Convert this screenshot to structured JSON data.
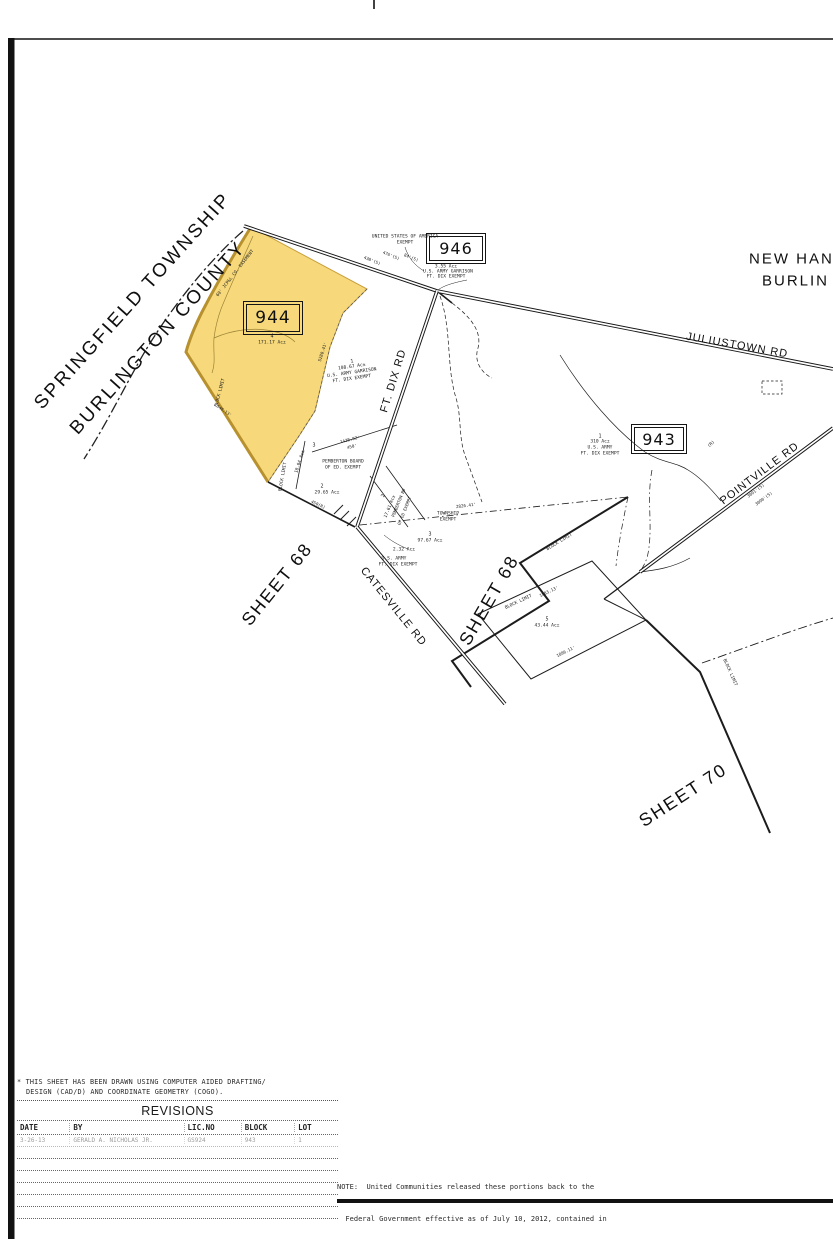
{
  "map": {
    "parcel_fill": "#f7d97b",
    "parcel_edge": "#b8912f",
    "blocks": [
      {
        "label": "944"
      },
      {
        "label": "946"
      },
      {
        "label": "943"
      }
    ],
    "annotations": [
      {
        "n": "township-name",
        "t": "SPRINGFIELD TOWNSHIP",
        "x": 133,
        "y": 301,
        "r": -48,
        "s": 19,
        "ls": 2.5,
        "f": "s"
      },
      {
        "n": "county-name",
        "t": "BURLINGTON COUNTY",
        "x": 158,
        "y": 338,
        "r": -48,
        "s": 19,
        "ls": 2.5,
        "f": "s"
      },
      {
        "n": "adjacent-township-name",
        "t": "NEW HAN",
        "x": 749,
        "y": 259,
        "r": 0,
        "s": 15,
        "ls": 2,
        "f": "s",
        "a": "l"
      },
      {
        "n": "adjacent-county-name",
        "t": "BURLIN",
        "x": 762,
        "y": 281,
        "r": 0,
        "s": 15,
        "ls": 2,
        "f": "s",
        "a": "l"
      },
      {
        "n": "owner-usa-line1",
        "t": "UNITED STATES OF AMERICA",
        "x": 405,
        "y": 238,
        "r": 0,
        "s": 4.6
      },
      {
        "n": "owner-usa-line2",
        "t": "EXEMPT",
        "x": 405,
        "y": 243.5,
        "r": 0,
        "s": 4.6
      },
      {
        "n": "dim-438",
        "t": "438'(S)",
        "x": 372,
        "y": 261,
        "r": 22,
        "s": 4.2
      },
      {
        "n": "dim-476",
        "t": "476'(S)",
        "x": 391,
        "y": 256,
        "r": 22,
        "s": 4.2
      },
      {
        "n": "dim-84",
        "t": "84'(S)",
        "x": 411,
        "y": 258,
        "r": 22,
        "s": 4.2
      },
      {
        "n": "parcel-355-acres",
        "t": "3.55 Ac±",
        "x": 446,
        "y": 268,
        "r": 0,
        "s": 4.6
      },
      {
        "n": "parcel-355-owner-1",
        "t": "U.S. ARMY GARRISON",
        "x": 448,
        "y": 273,
        "r": 0,
        "s": 4.6
      },
      {
        "n": "parcel-355-owner-2",
        "t": "FT. DIX EXEMPT",
        "x": 446,
        "y": 278,
        "r": 0,
        "s": 4.6
      },
      {
        "n": "lot-4-number",
        "t": "4",
        "x": 272,
        "y": 337,
        "r": 0,
        "s": 5
      },
      {
        "n": "lot-4-acres",
        "t": "171.17 Ac±",
        "x": 272,
        "y": 343.5,
        "r": 0,
        "s": 4.6
      },
      {
        "n": "easement-label",
        "t": "60' JCP&L CO. EASEMENT",
        "x": 236,
        "y": 274,
        "r": -52,
        "s": 4.4
      },
      {
        "n": "block-limit-label-1",
        "t": "BLOCK LIMIT",
        "x": 221,
        "y": 393,
        "r": -75,
        "s": 4.4
      },
      {
        "n": "dim-5280",
        "t": "5280.41'",
        "x": 323,
        "y": 352,
        "r": -72,
        "s": 4.2
      },
      {
        "n": "dim-546",
        "t": "546.13'",
        "x": 224,
        "y": 411,
        "r": 35,
        "s": 4
      },
      {
        "n": "road-ft-dix",
        "t": "FT. DIX RD",
        "x": 394,
        "y": 381,
        "r": -73,
        "s": 11,
        "ls": 1,
        "f": "s"
      },
      {
        "n": "lot-1-number",
        "t": "1",
        "x": 352,
        "y": 362,
        "r": -8,
        "s": 5
      },
      {
        "n": "lot-1-acres",
        "t": "108.67 Ac±",
        "x": 352,
        "y": 368,
        "r": -8,
        "s": 4.6
      },
      {
        "n": "lot-1-owner-1",
        "t": "U.S. ARMY GARRISON",
        "x": 352,
        "y": 374,
        "r": -8,
        "s": 4.6
      },
      {
        "n": "lot-1-owner-2",
        "t": "FT. DIX EXEMPT",
        "x": 352,
        "y": 380,
        "r": -8,
        "s": 4.6
      },
      {
        "n": "pemberton-board-1",
        "t": "PEMBERTON BOARD",
        "x": 343,
        "y": 463,
        "r": 0,
        "s": 4.6
      },
      {
        "n": "pemberton-board-2",
        "t": "OF ED. EXEMPT",
        "x": 343,
        "y": 468.5,
        "r": 0,
        "s": 4.6
      },
      {
        "n": "lot-3-number",
        "t": "3",
        "x": 314,
        "y": 446,
        "r": 0,
        "s": 5
      },
      {
        "n": "lot-3-acres",
        "t": "18.04 Ac±",
        "x": 301,
        "y": 462,
        "r": -72,
        "s": 4.4
      },
      {
        "n": "lot-2-number",
        "t": "2",
        "x": 322,
        "y": 487,
        "r": 0,
        "s": 5
      },
      {
        "n": "lot-2-acres",
        "t": "29.65 Ac±",
        "x": 327,
        "y": 494,
        "r": 0,
        "s": 4.6
      },
      {
        "n": "dim-1428",
        "t": "1428.92'",
        "x": 350,
        "y": 440,
        "r": -14,
        "s": 4.2
      },
      {
        "n": "dim-450a",
        "t": "450'",
        "x": 352,
        "y": 447,
        "r": -14,
        "s": 4.2
      },
      {
        "n": "dim-450r",
        "t": "450(R)",
        "x": 318,
        "y": 505,
        "r": 25,
        "s": 4.2
      },
      {
        "n": "lot-2b-number",
        "t": "2",
        "x": 384,
        "y": 496,
        "r": -68,
        "s": 5
      },
      {
        "n": "lot-2b-acres",
        "t": "17.61 Ac±",
        "x": 391,
        "y": 507,
        "r": -68,
        "s": 4.4
      },
      {
        "n": "lot-2b-owner-1",
        "t": "PEMBERTON BD",
        "x": 399,
        "y": 503,
        "r": -68,
        "s": 4.2
      },
      {
        "n": "lot-2b-owner-2",
        "t": "OF ED EXEMPT",
        "x": 405,
        "y": 511,
        "r": -68,
        "s": 4.2
      },
      {
        "n": "township-exempt-1",
        "t": "TOWNSHIP",
        "x": 448,
        "y": 515,
        "r": 0,
        "s": 4.6
      },
      {
        "n": "township-exempt-2",
        "t": "EXEMPT",
        "x": 448,
        "y": 520.5,
        "r": 0,
        "s": 4.6
      },
      {
        "n": "lot-3b-number",
        "t": "3",
        "x": 430,
        "y": 535,
        "r": 0,
        "s": 5
      },
      {
        "n": "lot-3b-acres",
        "t": "97.67 Ac±",
        "x": 430,
        "y": 541.5,
        "r": 0,
        "s": 4.6
      },
      {
        "n": "parcel-232-acres",
        "t": "2.32 Ac±",
        "x": 404,
        "y": 551,
        "r": 0,
        "s": 4.6
      },
      {
        "n": "army-1",
        "t": "U.S. ARMY",
        "x": 394,
        "y": 560,
        "r": 0,
        "s": 4.6
      },
      {
        "n": "army-2",
        "t": "FT. DIX EXEMPT",
        "x": 398,
        "y": 565.5,
        "r": 0,
        "s": 4.6
      },
      {
        "n": "lot-943-number",
        "t": "1",
        "x": 600,
        "y": 437,
        "r": 0,
        "s": 5
      },
      {
        "n": "lot-943-acres",
        "t": "310 Ac±",
        "x": 600,
        "y": 443,
        "r": 0,
        "s": 4.6
      },
      {
        "n": "lot-943-owner-1",
        "t": "U.S. ARMY",
        "x": 600,
        "y": 449,
        "r": 0,
        "s": 4.6
      },
      {
        "n": "lot-943-owner-2",
        "t": "FT. DIX EXEMPT",
        "x": 600,
        "y": 455,
        "r": 0,
        "s": 4.6
      },
      {
        "n": "r-mark",
        "t": "(R)",
        "x": 712,
        "y": 445,
        "r": -40,
        "s": 4.4
      },
      {
        "n": "road-juliustown",
        "t": "JULIUSTOWN RD",
        "x": 737,
        "y": 346,
        "r": 10,
        "s": 11,
        "ls": 1,
        "f": "s"
      },
      {
        "n": "road-pointville",
        "t": "POINTVILLE RD",
        "x": 760,
        "y": 474,
        "r": -37,
        "s": 11,
        "ls": 1,
        "f": "s"
      },
      {
        "n": "road-catesville",
        "t": "CATESVILLE RD",
        "x": 393,
        "y": 607,
        "r": 51,
        "s": 11,
        "ls": 1,
        "f": "s"
      },
      {
        "n": "sheet-68-left",
        "t": "SHEET 68",
        "x": 277,
        "y": 584,
        "r": -51,
        "s": 18,
        "ls": 2,
        "f": "s"
      },
      {
        "n": "sheet-68-center",
        "t": "SHEET 68",
        "x": 489,
        "y": 600,
        "r": -60,
        "s": 18,
        "ls": 2,
        "f": "s"
      },
      {
        "n": "sheet-70",
        "t": "SHEET 70",
        "x": 683,
        "y": 795,
        "r": -33,
        "s": 18,
        "ls": 2,
        "f": "s"
      },
      {
        "n": "dim-3091",
        "t": "3091'(S)",
        "x": 756,
        "y": 491,
        "r": -37,
        "s": 4.2
      },
      {
        "n": "dim-3090",
        "t": "3090'(S)",
        "x": 764,
        "y": 499,
        "r": -37,
        "s": 4.2
      },
      {
        "n": "block-limit-label-2",
        "t": "BLOCK LIMIT",
        "x": 729,
        "y": 673,
        "r": 66,
        "s": 4.4
      },
      {
        "n": "dim-2826",
        "t": "2826.41'",
        "x": 466,
        "y": 506,
        "r": -7,
        "s": 4.2
      },
      {
        "n": "block-limit-label-3",
        "t": "BLOCK LIMIT",
        "x": 560,
        "y": 543,
        "r": -31,
        "s": 4.4
      },
      {
        "n": "block-limit-label-4",
        "t": "BLOCK LIMIT",
        "x": 519,
        "y": 603,
        "r": -25,
        "s": 4.4
      },
      {
        "n": "dim-1883",
        "t": "1883.13'",
        "x": 549,
        "y": 592,
        "r": -25,
        "s": 4.2
      },
      {
        "n": "lot-5-number",
        "t": "5",
        "x": 547,
        "y": 620,
        "r": 0,
        "s": 5
      },
      {
        "n": "lot-5-acres",
        "t": "43.44 Ac±",
        "x": 547,
        "y": 627,
        "r": 0,
        "s": 4.6
      },
      {
        "n": "dim-1896",
        "t": "1896.11'",
        "x": 566,
        "y": 652,
        "r": -26,
        "s": 4.2
      },
      {
        "n": "block-limit-label-5",
        "t": "BLOCK LIMIT",
        "x": 284,
        "y": 477,
        "r": -80,
        "s": 4.4
      }
    ]
  },
  "footnote": {
    "line1": "* THIS SHEET HAS BEEN DRAWN USING COMPUTER AIDED DRAFTING/",
    "line2": "DESIGN (CAD/D) AND COORDINATE GEOMETRY (COGO)."
  },
  "revisions": {
    "title": "REVISIONS",
    "columns": [
      "DATE",
      "BY",
      "LIC.NO",
      "BLOCK",
      "LOT"
    ],
    "entry": {
      "date": "3-26-13",
      "by": "GERALD A. NICHOLAS JR.",
      "lic_no": "GS924",
      "block": "943",
      "lot": "1"
    }
  },
  "note": {
    "line1": "NOTE:  United Communities released these portions back to the",
    "line2": "  Federal Government effective as of July 10, 2012, contained in",
    "line3": "  Title 10, United States Code, Section 2878."
  }
}
